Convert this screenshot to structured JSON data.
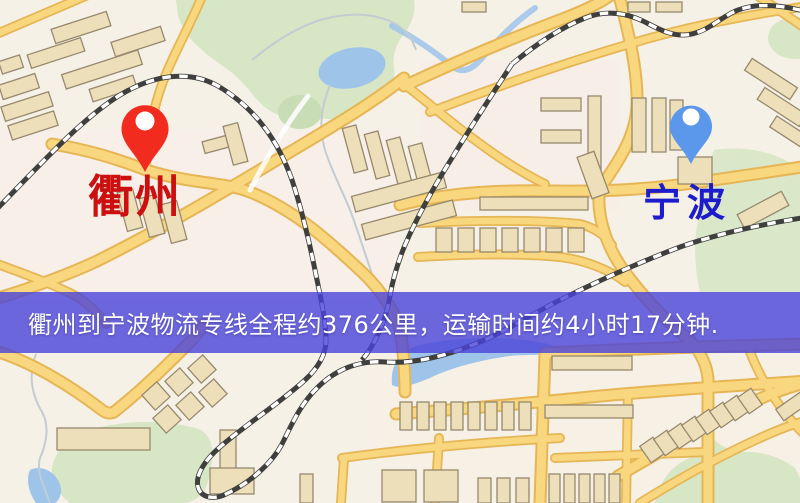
{
  "banner": {
    "text": "衢州到宁波物流专线全程约376公里，运输时间约4小时17分钟.",
    "text_color": "#ffffff"
  },
  "pins": {
    "quzhou": {
      "label": "衢州"
    },
    "ningbo": {
      "label": "宁波"
    }
  },
  "map": {
    "palette": {
      "bg": "#f6f1e7",
      "green": "#d7e6c4",
      "green2": "#c8ddb5",
      "water": "#9fc4ea",
      "road_casing": "#e6b656",
      "road_fill": "#f8d77e",
      "bldg_fill": "#ecdfb9",
      "bldg_stroke": "#97896e",
      "rail_base": "#3f3f3d",
      "rail_dash": "#ffffff",
      "banner": "rgba(74,68,218,0.80)",
      "qz_pin": "#f12b1d",
      "nb_pin": "#5b97ea",
      "qz_label": "#cc0f0f",
      "nb_label": "#1c1ccd"
    }
  }
}
